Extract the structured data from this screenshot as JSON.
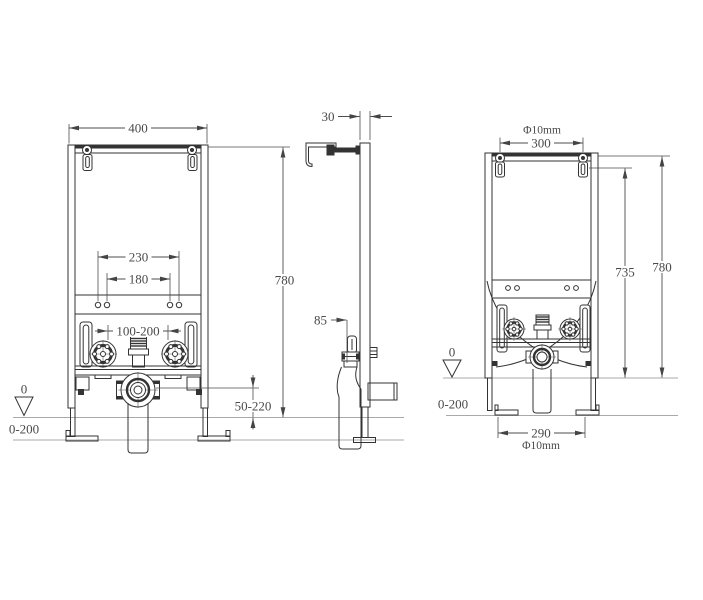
{
  "front_view": {
    "width": "400",
    "height": "780",
    "hole_span_outer": "230",
    "hole_span_inner": "180",
    "fixing_span": "100-200",
    "drain_height_range": "50-220",
    "datum_level": "0",
    "floor_range": "0-200"
  },
  "side_view": {
    "profile_depth": "30",
    "outlet_offset": "85"
  },
  "rear_view": {
    "top_hole_diameter": "Φ10mm",
    "top_hole_span": "300",
    "bracket_height": "735",
    "frame_height": "780",
    "base_hole_span": "290",
    "base_hole_diameter": "Φ10mm",
    "datum_level": "0",
    "floor_range": "0-200"
  }
}
